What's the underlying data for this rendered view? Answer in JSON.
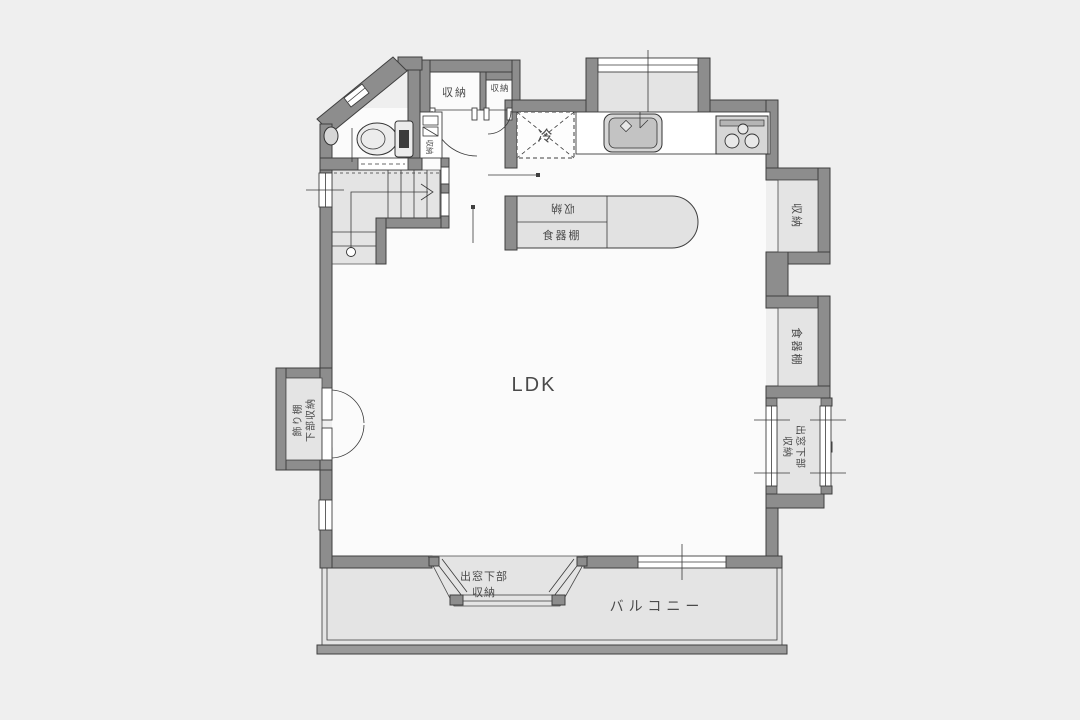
{
  "title": "LDK floor plan",
  "colors": {
    "background": "#efefef",
    "wall": "#8d8d8d",
    "floor": "#fbfbfb",
    "area_gray": "#e4e4e4",
    "line": "#3f3f3f",
    "text": "#4a4a4a"
  },
  "labels": {
    "ldk": "LDK",
    "balcony": "バルコニー",
    "fridge": "冷",
    "closet_large": "収納",
    "closet_small": "収納",
    "closet_slim": "収納",
    "island_storage": "収納",
    "island_cupboard": "食器棚",
    "wall_storage": "収納",
    "wall_cupboard": "食器棚",
    "bay_right_l1": "出窓下部",
    "bay_right_l2": "収納",
    "bay_bottom_l1": "出窓下部",
    "bay_bottom_l2": "収納",
    "shelf_l1": "飾り棚",
    "shelf_l2": "下部収納"
  }
}
